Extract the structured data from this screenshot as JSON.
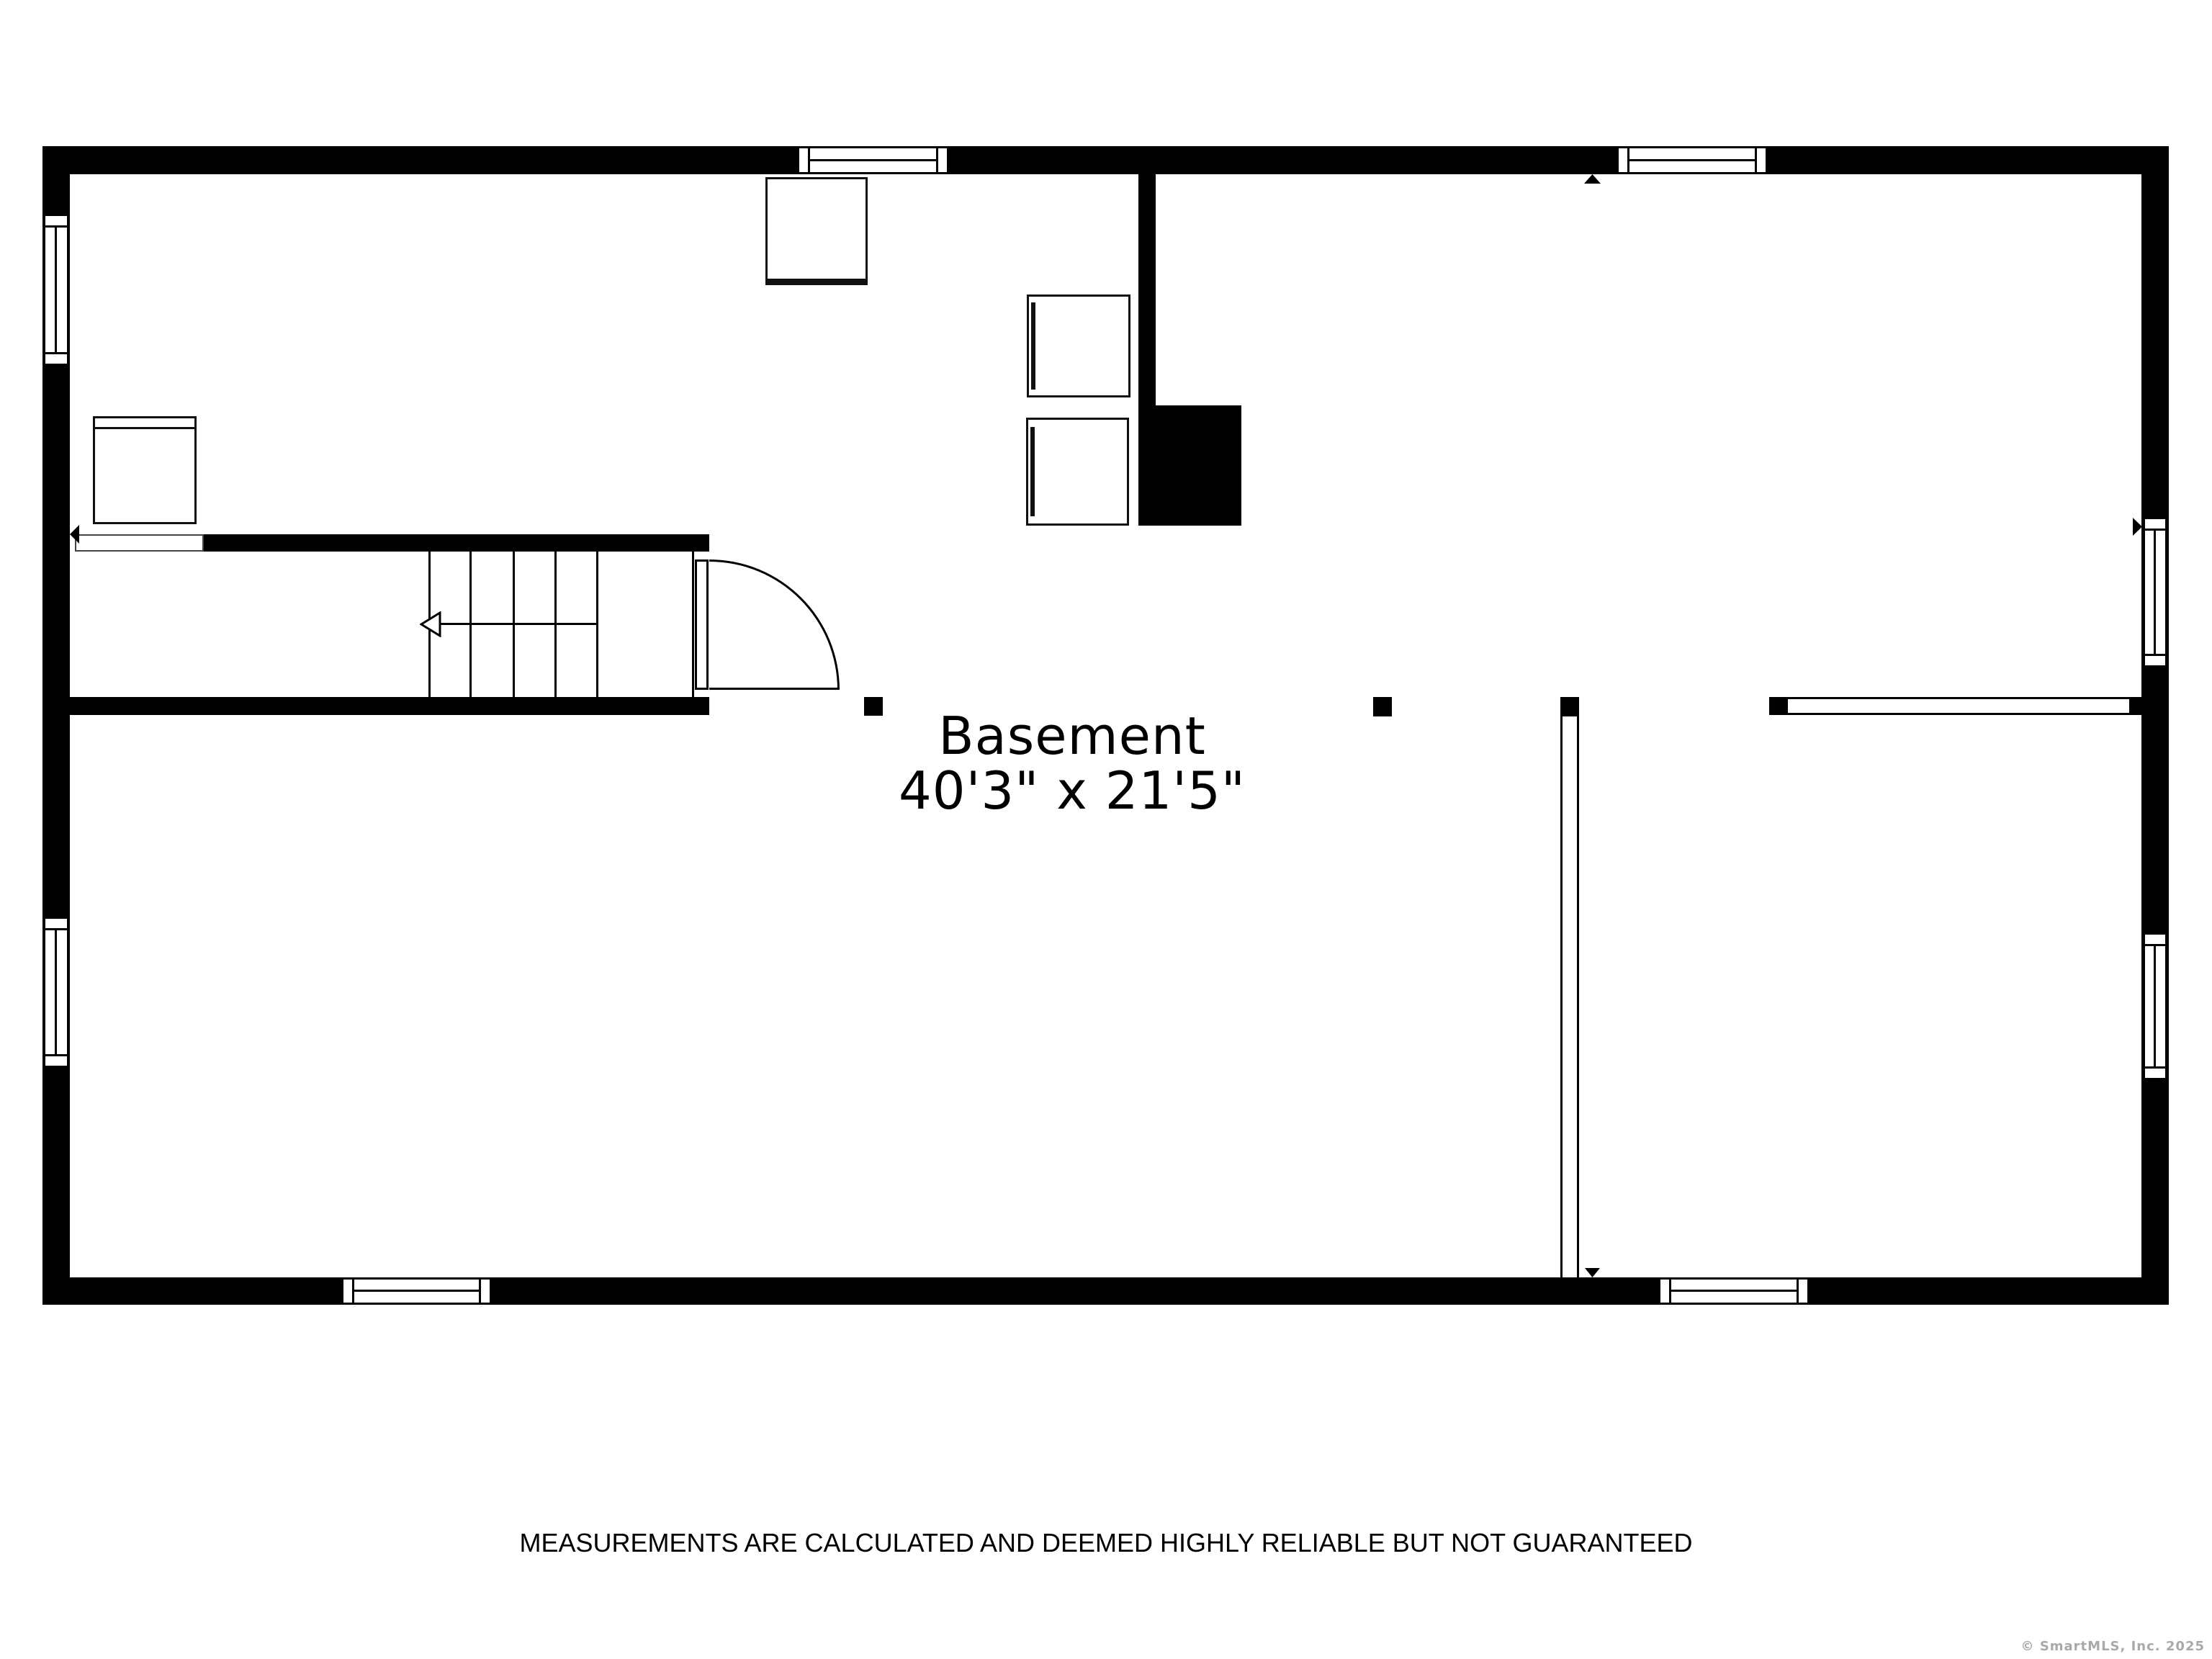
{
  "floorplan": {
    "room_label": "Basement",
    "room_dimensions": "40'3\" x 21'5\"",
    "disclaimer": "MEASUREMENTS ARE CALCULATED AND DEEMED HIGHLY RELIABLE BUT NOT GUARANTEED",
    "copyright": "© SmartMLS, Inc.  2025",
    "colors": {
      "wall": "#000000",
      "background": "#ffffff",
      "copyright_text": "#a9a9a9"
    },
    "icons": {
      "stair_direction": "arrow-left-outline-icon",
      "wall_markers": [
        "arrow-left-solid-icon",
        "arrow-up-solid-icon",
        "arrow-right-solid-icon",
        "arrow-down-solid-icon"
      ]
    },
    "counts": {
      "windows": 8,
      "doors": 1,
      "stair_treads": 5,
      "support_posts": 3
    }
  }
}
